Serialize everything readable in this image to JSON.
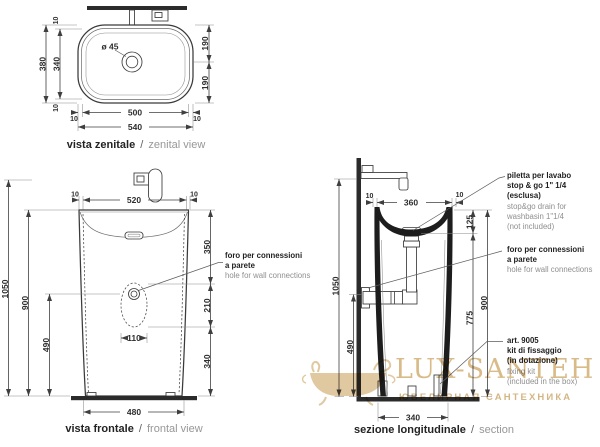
{
  "sep": "/",
  "zenital": {
    "caption_bold": "vista zenitale",
    "caption_light": "zenital view",
    "drain_label": "ø 45",
    "d_width_total": "540",
    "d_width_inner": "500",
    "d_margin": "10",
    "d_depth_total": "380",
    "d_depth_inner": "340",
    "d_half_top": "190",
    "d_half_bottom": "190"
  },
  "frontal": {
    "caption_bold": "vista frontale",
    "caption_light": "frontal view",
    "d_top_width": "520",
    "d_margin": "10",
    "d_h_total": "1050",
    "d_h_rim": "900",
    "d_h_hole": "490",
    "d_seg_top": "350",
    "d_seg_mid": "210",
    "d_seg_bot": "340",
    "d_hole_w": "110",
    "d_base": "480",
    "note": {
      "it1": "foro per connessioni",
      "it2": "a parete",
      "en1": "hole for wall connections"
    }
  },
  "section": {
    "caption_bold": "sezione longitudinale",
    "caption_light": "section",
    "d_top_width": "360",
    "d_margin": "10",
    "d_h_total": "1050",
    "d_h_hole": "490",
    "d_drain_drop": "125",
    "d_drain_h": "775",
    "d_h_rim": "900",
    "d_base": "340",
    "note_drain": {
      "it1": "piletta per lavabo",
      "it2": "stop & go 1\" 1/4",
      "it3": "(esclusa)",
      "en1": "stop&go drain for",
      "en2": "washbasin 1\"1/4",
      "en3": "(not included)"
    },
    "note_hole": {
      "it1": "foro per connessioni",
      "it2": "a parete",
      "en1": "hole for wall connections"
    },
    "note_kit": {
      "it1": "art. 9005",
      "it2": "kit di fissaggio",
      "it3": "(in dotazione)",
      "en1": "fixing kit",
      "en2": "(included in the box)"
    }
  },
  "watermark": {
    "brand": "LUX-SANTEH",
    "tagline": "ЮВЕЛИРНАЯ САНТЕХНИКА"
  }
}
